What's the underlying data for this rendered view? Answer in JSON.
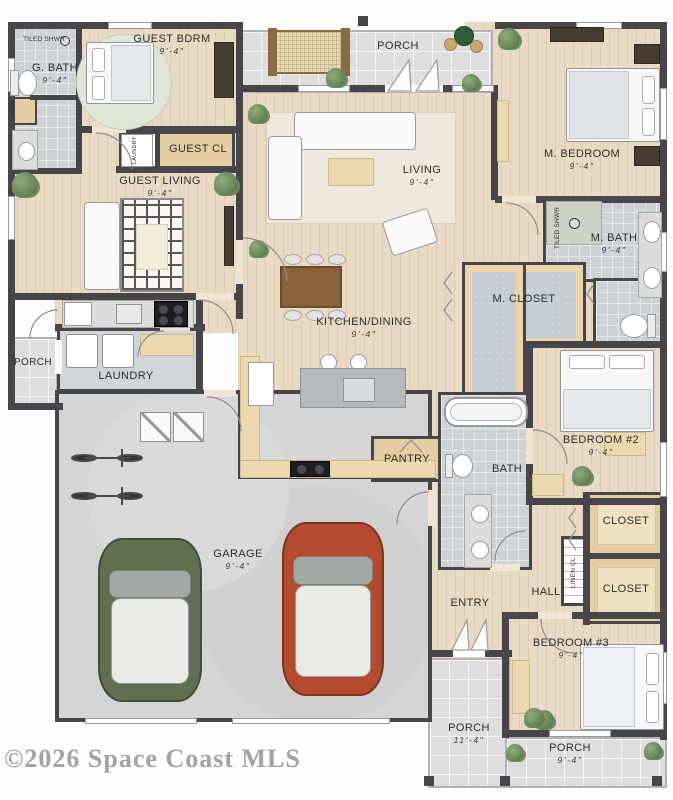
{
  "watermark": "©2026 Space Coast MLS",
  "palette": {
    "wall": "#46464a",
    "wood_floor": "#e9dac3",
    "porch_tile": "#dedede",
    "bath_tile": "#cdd2d5",
    "closet_carpet": "#c6cdd3",
    "closet_tan": "#e4cda2",
    "watermark_gray": "#a3a3a3"
  },
  "rooms": {
    "porch_top": {
      "label": "PORCH"
    },
    "guest_bdrm": {
      "label": "GUEST BDRM",
      "dim": "9'-4\""
    },
    "tiled_shwr_guest": {
      "label": "TILED SHWR"
    },
    "guest_bath": {
      "label": "G. BATH",
      "dim": "9'-4\""
    },
    "linen_guest": {
      "label": "LINEN"
    },
    "guest_cl": {
      "label": "GUEST CL"
    },
    "guest_laundry_cl": {
      "label": "LAUNDRY"
    },
    "guest_living": {
      "label": "GUEST LIVING",
      "dim": "9'-4\""
    },
    "living": {
      "label": "LIVING",
      "dim": "9'-4\""
    },
    "m_bedroom": {
      "label": "M. BEDROOM",
      "dim": "9'-4\""
    },
    "tiled_shwr_m": {
      "label": "TILED SHWR"
    },
    "m_bath": {
      "label": "M. BATH",
      "dim": "9'-4\""
    },
    "m_closet": {
      "label": "M. CLOSET"
    },
    "kitchen_dining": {
      "label": "KITCHEN/DINING",
      "dim": "9'-4\""
    },
    "porch_left": {
      "label": "PORCH"
    },
    "laundry": {
      "label": "LAUNDRY"
    },
    "pantry": {
      "label": "PANTRY"
    },
    "garage": {
      "label": "GARAGE",
      "dim": "9'-4\""
    },
    "bath": {
      "label": "BATH"
    },
    "bedroom2": {
      "label": "BEDROOM #2",
      "dim": "9'-4\""
    },
    "closet_a": {
      "label": "CLOSET"
    },
    "closet_b": {
      "label": "CLOSET"
    },
    "linen_cl": {
      "label": "LINEN CL"
    },
    "hall": {
      "label": "HALL"
    },
    "entry": {
      "label": "ENTRY"
    },
    "bedroom3": {
      "label": "BEDROOM #3",
      "dim": "9'-4\""
    },
    "porch_bottom_left": {
      "label": "PORCH",
      "dim": "11'-4\""
    },
    "porch_bottom_right": {
      "label": "PORCH",
      "dim": "9'-4\""
    }
  }
}
